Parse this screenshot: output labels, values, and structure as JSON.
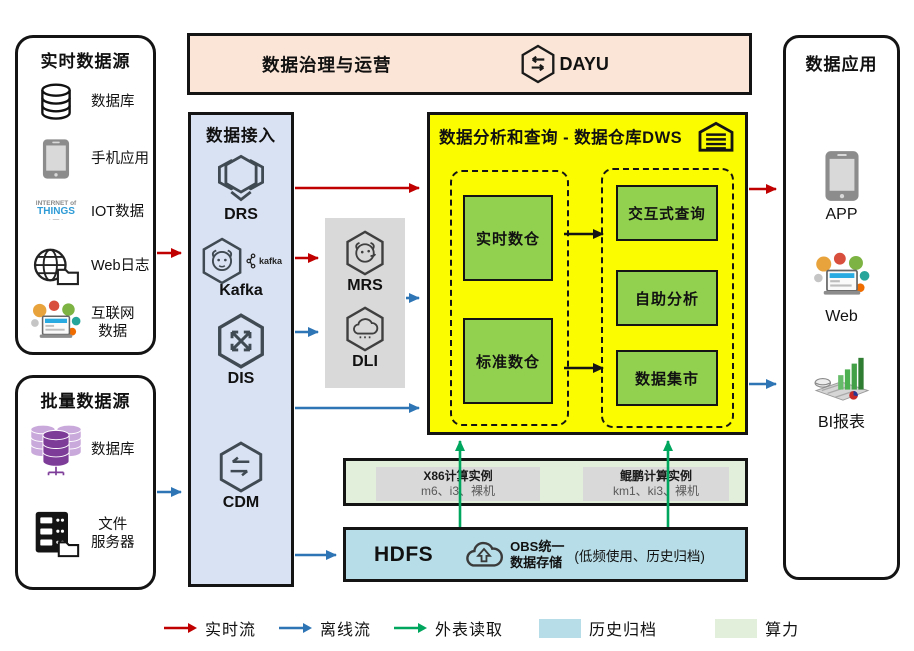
{
  "colors": {
    "realtime_flow": "#C00000",
    "offline_flow": "#2E75B6",
    "external_read": "#00A65E",
    "history_archive_bg": "#B7DEE8",
    "compute_power_bg": "#E2EFDA",
    "governance_bg": "#FBE5D6",
    "ingestion_bg": "#D9E2F3",
    "dws_bg": "#FCFC00",
    "dws_module_green": "#92D050",
    "instance_gray": "#D9D9D9"
  },
  "realtime_sources": {
    "title": "实时数据源",
    "items": [
      {
        "icon": "database-icon",
        "label": "数据库"
      },
      {
        "icon": "mobile-phone-icon",
        "label": "手机应用"
      },
      {
        "icon": "iot-wordcloud-icon",
        "label": "IOT数据",
        "cloud_line1": "INTERNET of",
        "cloud_line2": "THINGS",
        "cloud_line3": "· — ·"
      },
      {
        "icon": "web-log-icon",
        "label": "Web日志"
      },
      {
        "icon": "internet-data-icon",
        "label": "互联网",
        "label2": "数据"
      }
    ]
  },
  "batch_sources": {
    "title": "批量数据源",
    "items": [
      {
        "icon": "database-cluster-icon",
        "label": "数据库"
      },
      {
        "icon": "file-server-icon",
        "label": "文件",
        "label2": "服务器"
      }
    ]
  },
  "governance": {
    "title": "数据治理与运营",
    "product": "DAYU"
  },
  "ingestion": {
    "title": "数据接入",
    "services": [
      {
        "icon": "drs-icon",
        "label": "DRS"
      },
      {
        "icon": "kafka-icon",
        "label": "Kafka",
        "logo_text": "kafka"
      },
      {
        "icon": "dis-icon",
        "label": "DIS"
      },
      {
        "icon": "cdm-icon",
        "label": "CDM"
      }
    ]
  },
  "processing": {
    "services": [
      {
        "icon": "mrs-icon",
        "label": "MRS"
      },
      {
        "icon": "dli-icon",
        "label": "DLI"
      }
    ]
  },
  "dws": {
    "title": "数据分析和查询 - 数据仓库DWS",
    "warehouse_modules": [
      "实时数仓",
      "标准数仓"
    ],
    "analysis_modules": [
      "交互式查询",
      "自助分析",
      "数据集市"
    ]
  },
  "compute": {
    "instances": [
      {
        "name": "X86计算实例",
        "specs": "m6、i3、裸机"
      },
      {
        "name": "鲲鹏计算实例",
        "specs": "km1、ki3、裸机"
      }
    ]
  },
  "storage": {
    "hdfs": "HDFS",
    "obs_line1": "OBS统一",
    "obs_line2": "数据存储",
    "note": "(低频使用、历史归档)"
  },
  "applications": {
    "title": "数据应用",
    "items": [
      {
        "icon": "mobile-phone-icon",
        "label": "APP"
      },
      {
        "icon": "web-portal-icon",
        "label": "Web"
      },
      {
        "icon": "bi-report-icon",
        "label": "BI报表"
      }
    ]
  },
  "legend": {
    "items": [
      {
        "kind": "arrow",
        "color": "#C00000",
        "label": "实时流"
      },
      {
        "kind": "arrow",
        "color": "#2E75B6",
        "label": "离线流"
      },
      {
        "kind": "arrow",
        "color": "#00A65E",
        "label": "外表读取"
      },
      {
        "kind": "swatch",
        "color": "#B7DEE8",
        "label": "历史归档"
      },
      {
        "kind": "swatch",
        "color": "#E2EFDA",
        "label": "算力"
      }
    ]
  }
}
